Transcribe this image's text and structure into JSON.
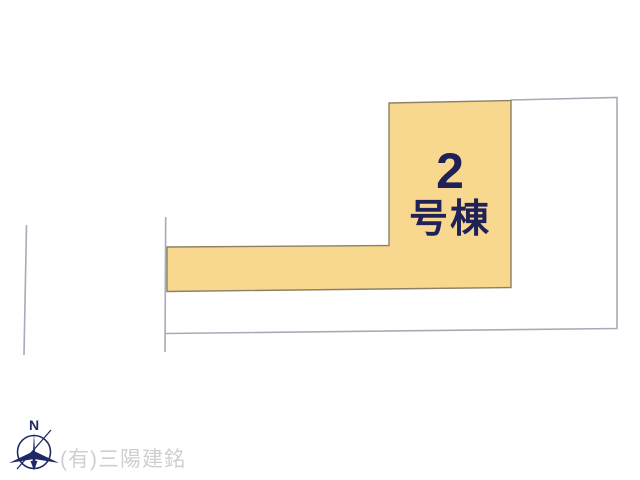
{
  "lot": {
    "number": "2",
    "suffix": "号棟",
    "fill_color": "#F8D78E",
    "border_color": "#8B8166",
    "text_color": "#1F2157"
  },
  "boundary": {
    "line_color": "#A6ABB7"
  },
  "compass": {
    "label": "N",
    "color": "#1E2A66"
  },
  "watermark": {
    "text": "(有)三陽建銘",
    "color": "#CFCFCF"
  }
}
